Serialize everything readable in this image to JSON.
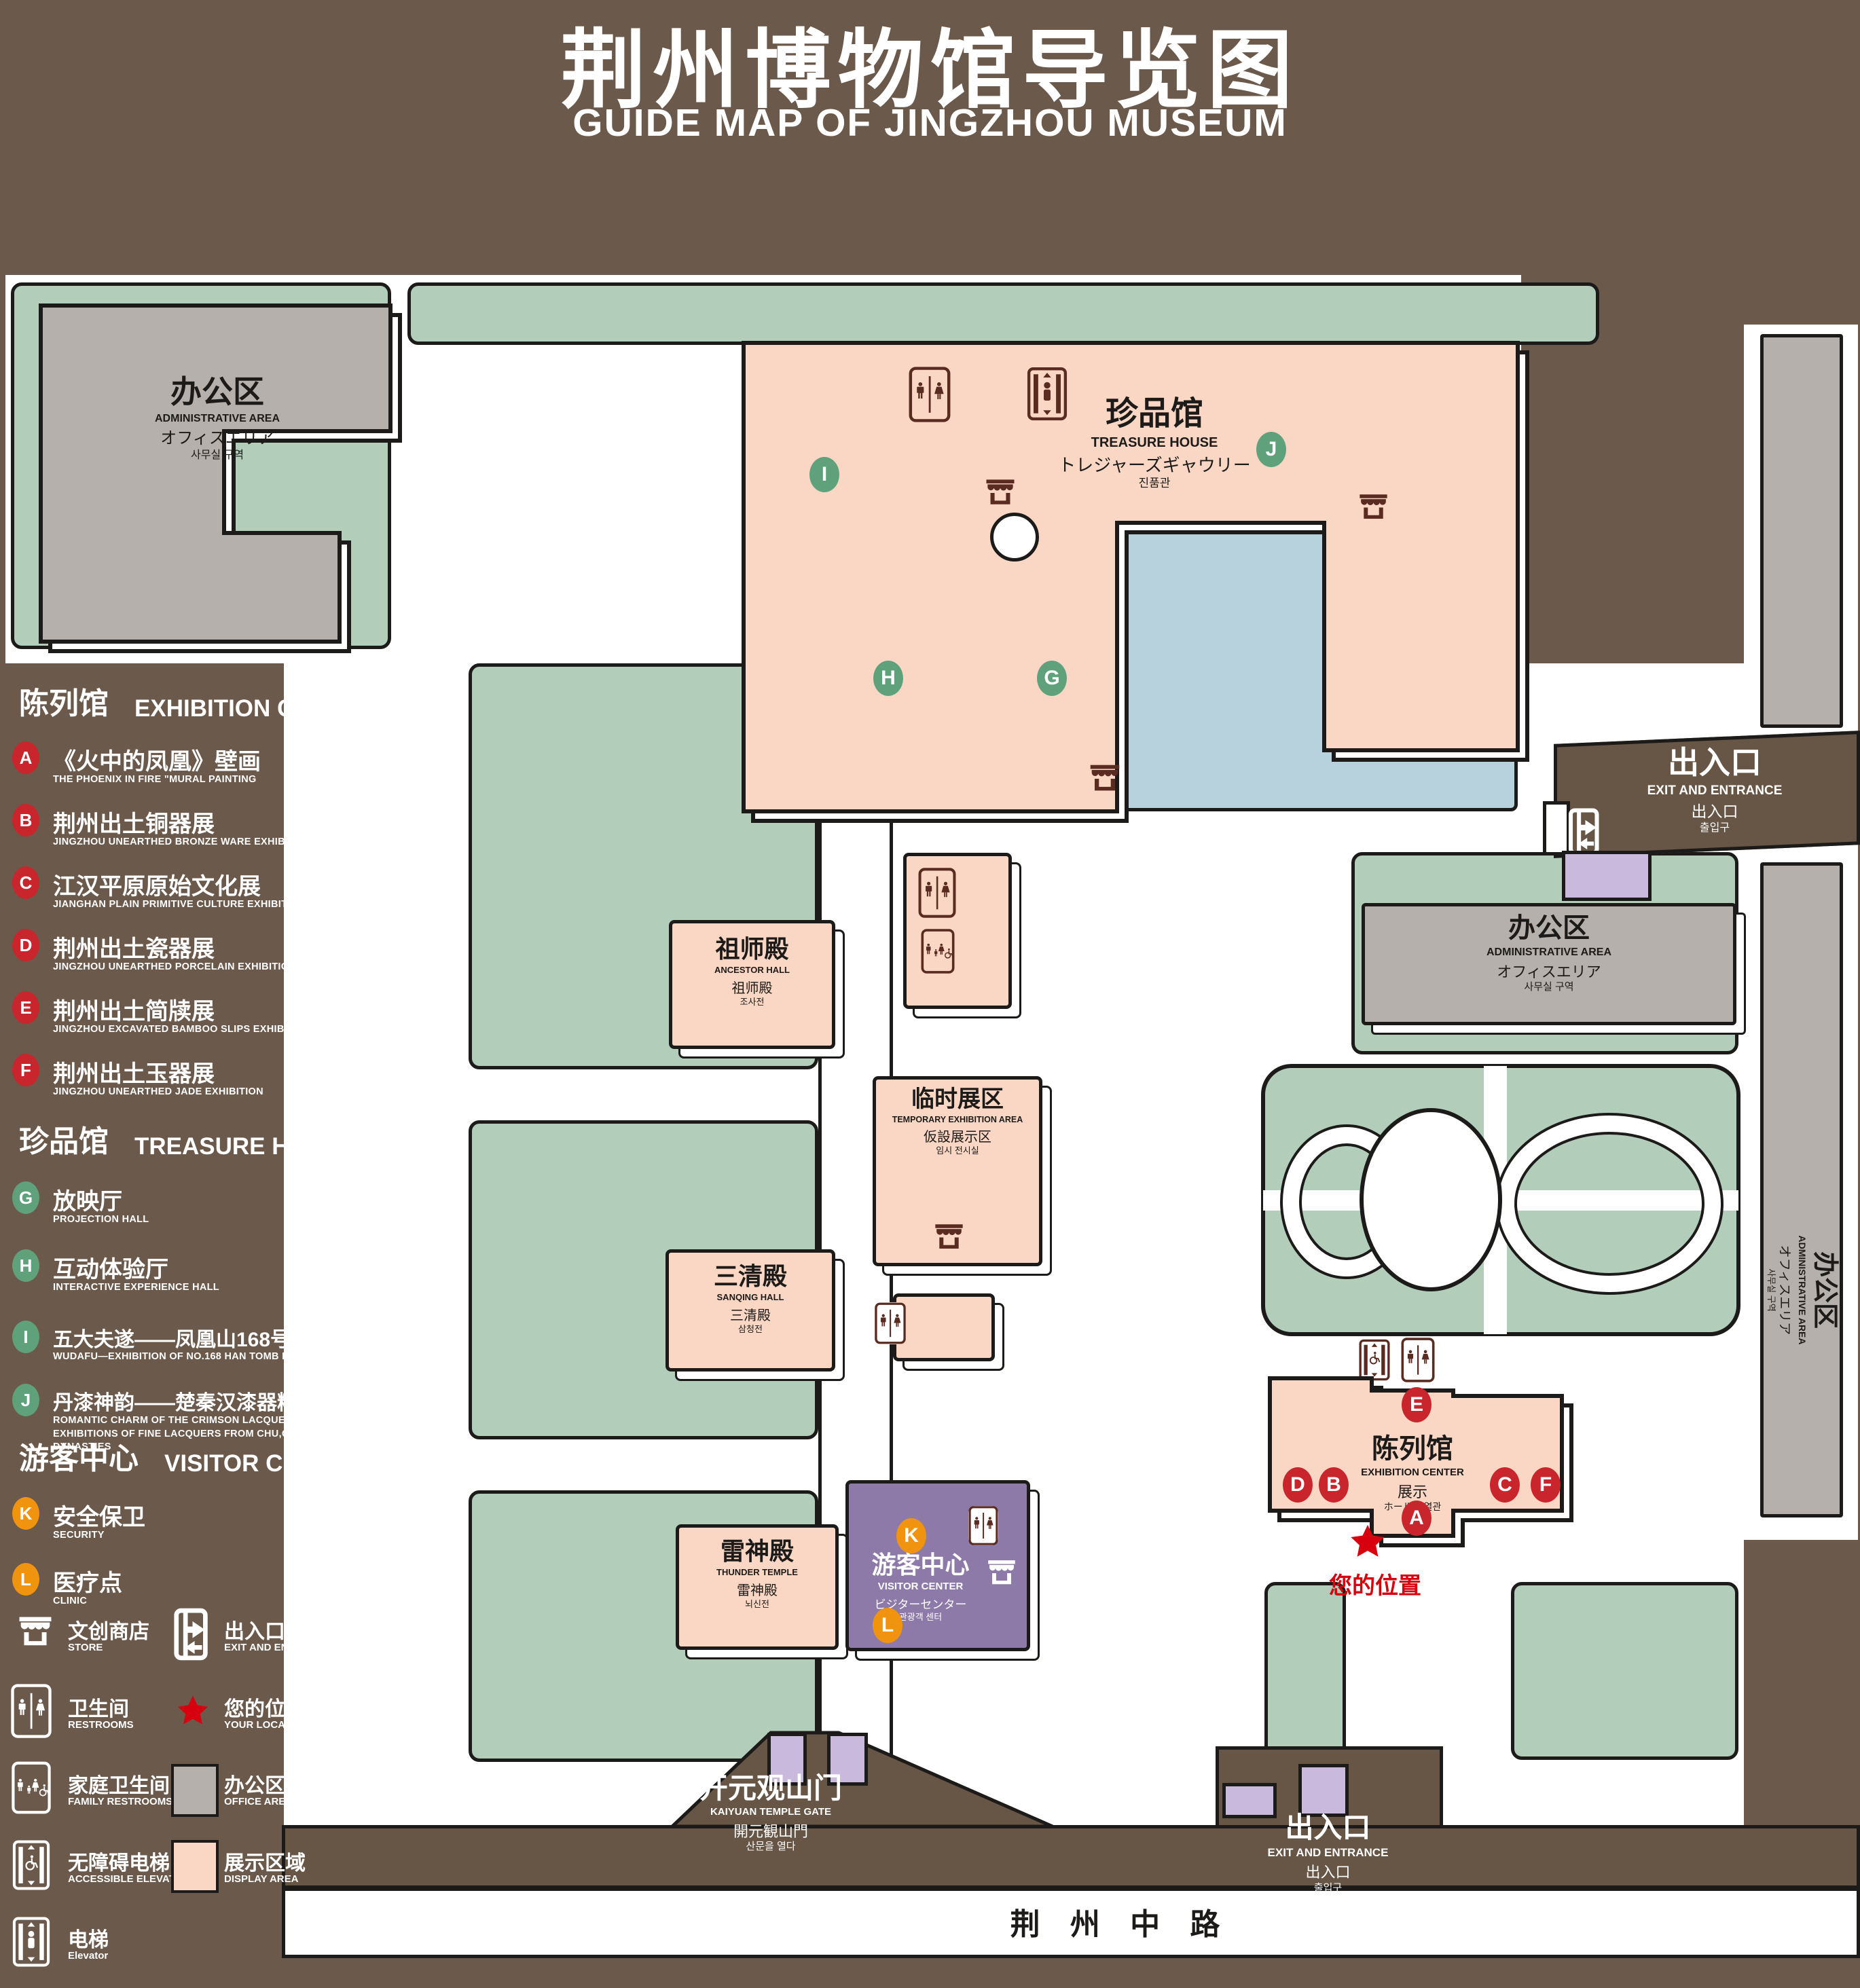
{
  "title": {
    "zh": "荆州博物馆导览图",
    "en": "GUIDE MAP OF JINGZHOU MUSEUM"
  },
  "colors": {
    "background": "#6b594b",
    "courtyard_green": "#b3cdbb",
    "display_pink": "#f9d7c4",
    "office_gray": "#b5b0ab",
    "water_blue": "#b7d2dd",
    "visitor_purple": "#8d7aa9",
    "entrance_lavender": "#c9b9dc",
    "road_brown": "#675546",
    "marker_red": "#c9252c",
    "marker_green": "#5fa17b",
    "marker_orange": "#f0930f",
    "icon_maroon": "#5a2b21",
    "location_red": "#d7000f",
    "outline": "#1d1b19"
  },
  "legend": {
    "sections": [
      {
        "zh": "陈列馆",
        "en": "EXHIBITION CENTER",
        "items": [
          {
            "key": "A",
            "zh": "《火中的凤凰》壁画",
            "en": "THE PHOENIX IN FIRE \"MURAL PAINTING",
            "floor": "1F"
          },
          {
            "key": "B",
            "zh": "荆州出土铜器展",
            "en": "JINGZHOU UNEARTHED BRONZE WARE EXHIBITION",
            "floor": "1F"
          },
          {
            "key": "C",
            "zh": "江汉平原原始文化展",
            "en": "JIANGHAN PLAIN PRIMITIVE CULTURE EXHIBITION",
            "floor": "1F"
          },
          {
            "key": "D",
            "zh": "荆州出土瓷器展",
            "en": "JINGZHOU UNEARTHED PORCELAIN EXHIBITIONE",
            "floor": "2F"
          },
          {
            "key": "E",
            "zh": "荆州出土简牍展",
            "en": "JINGZHOU EXCAVATED BAMBOO SLIPS EXHIBITION",
            "floor": "2F"
          },
          {
            "key": "F",
            "zh": "荆州出土玉器展",
            "en": "JINGZHOU UNEARTHED JADE EXHIBITION",
            "floor": "2F"
          }
        ]
      },
      {
        "zh": "珍品馆",
        "en": "TREASURE HOUSE",
        "items": [
          {
            "key": "G",
            "zh": "放映厅",
            "en": "PROJECTION HALL",
            "floor": "1F"
          },
          {
            "key": "H",
            "zh": "互动体验厅",
            "en": "INTERACTIVE EXPERIENCE HALL",
            "floor": "1F"
          },
          {
            "key": "I",
            "zh": "五大夫遂——凤凰山168号汉墓展",
            "en": "WUDAFU—EXHIBITION OF NO.168 HAN TOMB FROM FENGHUANGSHAN",
            "floor": "2F"
          },
          {
            "key": "J",
            "zh": "丹漆神韵——楚秦汉漆器精品展",
            "en": "ROMANTIC CHARM OF THE CRIMSON LACQUERS—EXHIBITIONS OF FINE LACQUERS FROM CHU,QIN AND HAN DYNASTIES",
            "floor": "1-2F"
          }
        ]
      },
      {
        "zh": "游客中心",
        "en": "VISITOR CENTER",
        "items": [
          {
            "key": "K",
            "zh": "安全保卫",
            "en": "SECURITY",
            "floor": "1F"
          },
          {
            "key": "L",
            "zh": "医疗点",
            "en": "CLINIC",
            "floor": "1F"
          }
        ]
      }
    ],
    "symbols": [
      {
        "icon": "store-icon",
        "zh": "文创商店",
        "en": "STORE"
      },
      {
        "icon": "exit-icon",
        "zh": "出入口",
        "en": "EXIT AND ENTRANCE"
      },
      {
        "icon": "restroom-icon",
        "zh": "卫生间",
        "en": "RESTROOMS"
      },
      {
        "icon": "location-star-icon",
        "zh": "您的位置",
        "en": "YOUR LOCATION"
      },
      {
        "icon": "family-restroom-icon",
        "zh": "家庭卫生间",
        "en": "FAMILY RESTROOMS"
      },
      {
        "icon": "office-area-swatch",
        "zh": "办公区域",
        "en": "OFFICE AREA"
      },
      {
        "icon": "accessible-elevator-icon",
        "zh": "无障碍电梯",
        "en": "ACCESSIBLE ELEVATOR"
      },
      {
        "icon": "display-area-swatch",
        "zh": "展示区域",
        "en": "DISPLAY AREA"
      },
      {
        "icon": "elevator-icon",
        "zh": "电梯",
        "en": "Elevator"
      }
    ]
  },
  "map": {
    "buildings": {
      "admin_nw": {
        "zh": "办公区",
        "en": "ADMINISTRATIVE AREA",
        "ja": "オフィスエリア",
        "ko": "사무실 구역"
      },
      "treasure_house": {
        "zh": "珍品馆",
        "en": "TREASURE HOUSE",
        "ja": "トレジャーズギャウリー",
        "ko": "진품관"
      },
      "admin_mid": {
        "zh": "办公区",
        "en": "ADMINISTRATIVE AREA",
        "ja": "オフィスエリア",
        "ko": "사무실 구역"
      },
      "admin_east": {
        "zh": "办公区",
        "en": "ADMINISTRATIVE AREA",
        "ja": "オフィスエリア",
        "ko": "사무실 구역"
      },
      "ancestor_hall": {
        "zh": "祖师殿",
        "en": "ANCESTOR HALL",
        "ja": "祖师殿",
        "ko": "조사전"
      },
      "temporary_exhibition": {
        "zh": "临时展区",
        "en": "TEMPORARY EXHIBITION AREA",
        "ja": "仮設展示区",
        "ko": "임시 전시실"
      },
      "sanqing_hall": {
        "zh": "三清殿",
        "en": "SANQING HALL",
        "ja": "三清殿",
        "ko": "삼청전"
      },
      "thunder_temple": {
        "zh": "雷神殿",
        "en": "THUNDER TEMPLE",
        "ja": "雷神殿",
        "ko": "뇌신전"
      },
      "visitor_center": {
        "zh": "游客中心",
        "en": "VISITOR CENTER",
        "ja": "ビジターセンター",
        "ko": "관광객 센터"
      },
      "exhibition_center": {
        "zh": "陈列馆",
        "en": "EXHIBITION CENTER",
        "l3": "展示",
        "l4": "ホール 진열관"
      },
      "kaiyuan_gate": {
        "zh": "开元观山门",
        "en": "KAIYUAN TEMPLE GATE",
        "ja": "開元観山門",
        "ko": "산문을 열다"
      },
      "exit_ne": {
        "zh": "出入口",
        "en": "EXIT AND ENTRANCE",
        "ja": "出入口",
        "ko": "출입구"
      },
      "exit_s": {
        "zh": "出入口",
        "en": "EXIT AND ENTRANCE",
        "ja": "出入口",
        "ko": "출입구"
      },
      "road": {
        "zh": "荆 州 中 路"
      },
      "your_location": {
        "zh": "您的位置"
      }
    },
    "markers": {
      "A": "A",
      "B": "B",
      "C": "C",
      "D": "D",
      "E": "E",
      "F": "F",
      "G": "G",
      "H": "H",
      "I": "I",
      "J": "J",
      "K": "K",
      "L": "L"
    }
  }
}
